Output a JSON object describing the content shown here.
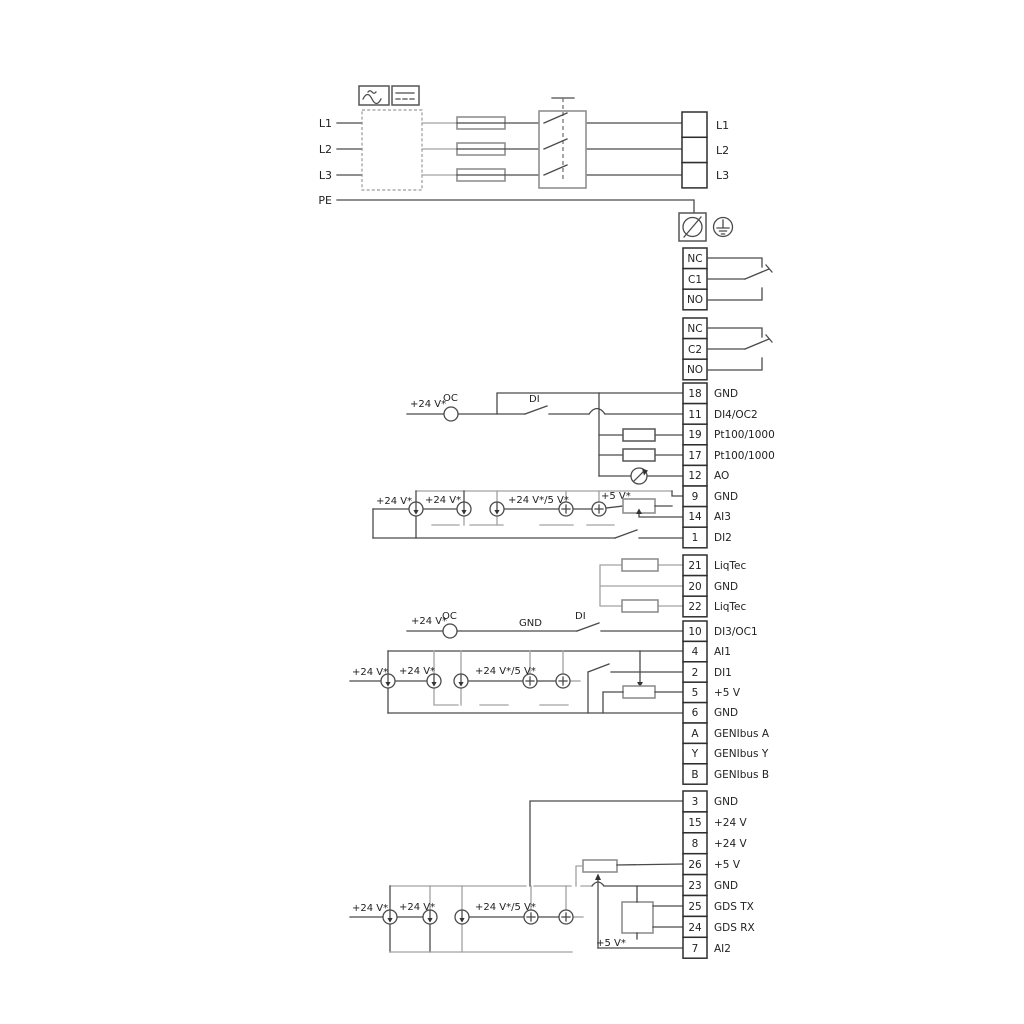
{
  "d": {
    "mains_in": [
      "L1",
      "L2",
      "L3"
    ],
    "pe": "PE",
    "mains_out": [
      "L1",
      "L2",
      "L3"
    ],
    "relay1": [
      "NC",
      "C1",
      "NO"
    ],
    "relay2": [
      "NC",
      "C2",
      "NO"
    ],
    "io1": [
      {
        "num": "18",
        "label": "GND"
      },
      {
        "num": "11",
        "label": "DI4/OC2"
      },
      {
        "num": "19",
        "label": "Pt100/1000"
      },
      {
        "num": "17",
        "label": "Pt100/1000"
      },
      {
        "num": "12",
        "label": "AO"
      },
      {
        "num": "9",
        "label": "GND"
      },
      {
        "num": "14",
        "label": "AI3"
      },
      {
        "num": "1",
        "label": "DI2"
      }
    ],
    "io2": [
      {
        "num": "21",
        "label": "LiqTec"
      },
      {
        "num": "20",
        "label": "GND"
      },
      {
        "num": "22",
        "label": "LiqTec"
      }
    ],
    "io3": [
      {
        "num": "10",
        "label": "DI3/OC1"
      },
      {
        "num": "4",
        "label": "AI1"
      },
      {
        "num": "2",
        "label": "DI1"
      },
      {
        "num": "5",
        "label": "+5 V"
      },
      {
        "num": "6",
        "label": "GND"
      },
      {
        "num": "A",
        "label": "GENIbus A"
      },
      {
        "num": "Y",
        "label": "GENIbus Y"
      },
      {
        "num": "B",
        "label": "GENIbus B"
      }
    ],
    "io4": [
      {
        "num": "3",
        "label": "GND"
      },
      {
        "num": "15",
        "label": "+24 V"
      },
      {
        "num": "8",
        "label": "+24 V"
      },
      {
        "num": "26",
        "label": "+5 V"
      },
      {
        "num": "23",
        "label": "GND"
      },
      {
        "num": "25",
        "label": "GDS TX"
      },
      {
        "num": "24",
        "label": "GDS RX"
      },
      {
        "num": "7",
        "label": "AI2"
      }
    ],
    "ann": {
      "p24": "+24 V*",
      "p24or5": "+24 V*/5 V*",
      "p5": "+5 V*",
      "oc": "OC",
      "di": "DI",
      "gnd": "GND"
    },
    "colors": {
      "wire": "#4a4a4a",
      "wire_gray": "#a2a2a2",
      "text": "#222222"
    }
  }
}
